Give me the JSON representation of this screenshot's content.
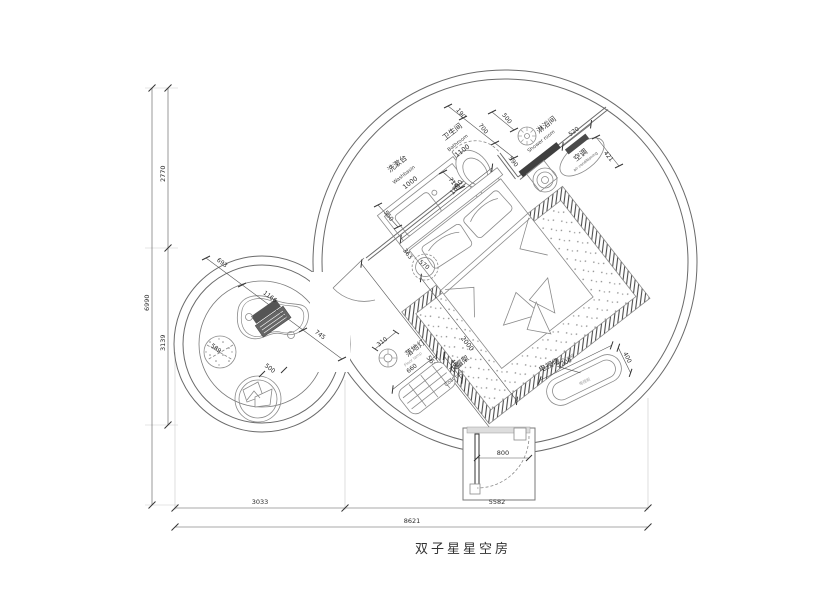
{
  "title": "双子星星空房",
  "rooms": {
    "washbasin": {
      "cn": "洗漱台",
      "en": "Washbasin",
      "width": "1000"
    },
    "bathroom": {
      "cn": "卫生间",
      "en": "Bathroom",
      "width": "1100"
    },
    "shower": {
      "cn": "淋浴间",
      "en": "Shower room"
    },
    "ac": {
      "cn": "空调",
      "en": "air conditioning",
      "width": "520",
      "depth": "421"
    }
  },
  "furniture": {
    "floor_lamp": {
      "cn": "落地灯",
      "en": "Floor lamp",
      "dia": "310"
    },
    "coat_rack": {
      "cn": "衣帽架",
      "en": "Coat rack",
      "width": "660",
      "depth": "400"
    },
    "tv_wall": {
      "cn": "电视墙",
      "en": "TV wall",
      "width": "1200",
      "depth": "400",
      "cabinet": "电视柜"
    },
    "bed": {
      "width": "1800",
      "length": "2000"
    },
    "stool": {
      "dia": "363",
      "offset": "570"
    },
    "table": {
      "d1": "693",
      "d2": "1166",
      "d3": "745"
    },
    "ottoman": {
      "dia": "589"
    },
    "round_chair": {
      "dia": "500"
    },
    "entry_door": {
      "width": "800"
    }
  },
  "dims": {
    "bath_chain": {
      "d1": "190",
      "d2": "700",
      "d3": "500",
      "d4": "590"
    },
    "vanity_depth": "550",
    "toilet_offset": "714",
    "room_diag": "5684",
    "left": {
      "total": "6990",
      "top": "2770",
      "bottom": "3139"
    },
    "bottom": {
      "total": "8621",
      "left": "3033",
      "right": "5582"
    }
  }
}
